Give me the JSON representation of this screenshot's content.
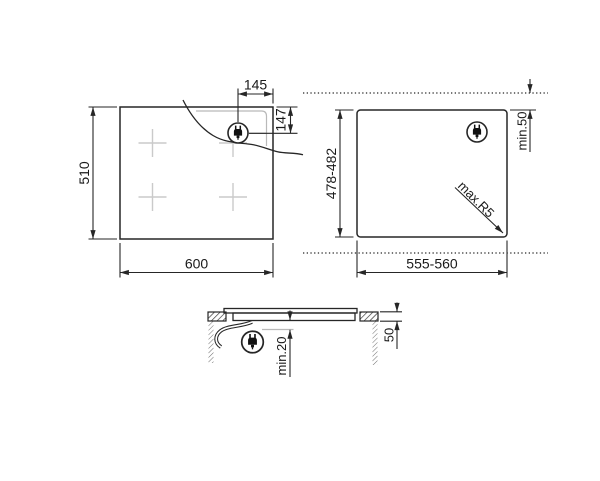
{
  "colors": {
    "background": "#ffffff",
    "line": "#262626",
    "hidden_detail_line": "#b9b9b9",
    "zone_cross": "#cacaca",
    "text": "#1a1a1a"
  },
  "top_view": {
    "width": "600",
    "height": "510",
    "plug_offset_from_right": "145",
    "plug_offset_from_top": "147",
    "plug_icon": "power-plug"
  },
  "cutout_view": {
    "width": "555-560",
    "height": "478-482",
    "rear_clearance": "min.50",
    "corner_radius": "max.R5",
    "plug_icon": "power-plug"
  },
  "section_view": {
    "under_clearance": "min.20",
    "worktop_depth": "50",
    "plug_icon": "power-plug"
  }
}
